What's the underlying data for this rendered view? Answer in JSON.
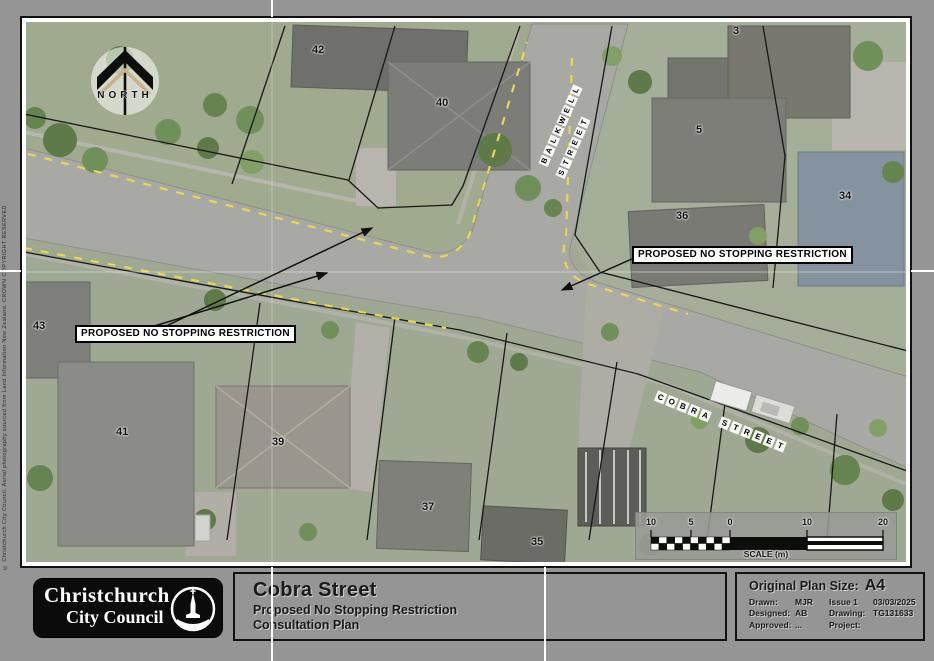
{
  "map": {
    "north_label": "NORTH",
    "copyright_text": "© Christchurch City Council. Aerial photography sourced from Land Information New Zealand. CROWN COPYRIGHT RESERVED. Licensed for re-use.",
    "labels": {
      "no_stopping_left": "PROPOSED NO STOPPING RESTRICTION",
      "no_stopping_right": "PROPOSED NO STOPPING RESTRICTION"
    },
    "streets": {
      "cobra": {
        "words": [
          "COBRA",
          "STREET"
        ]
      },
      "side": {
        "line1": "BALKWELL",
        "line2": "STREET"
      }
    },
    "house_numbers": [
      {
        "label": "42",
        "x": 312,
        "y": 44
      },
      {
        "label": "40",
        "x": 436,
        "y": 97
      },
      {
        "label": "3",
        "x": 733,
        "y": 25
      },
      {
        "label": "5",
        "x": 696,
        "y": 124
      },
      {
        "label": "36",
        "x": 676,
        "y": 210
      },
      {
        "label": "34",
        "x": 839,
        "y": 190
      },
      {
        "label": "43",
        "x": 33,
        "y": 320
      },
      {
        "label": "41",
        "x": 116,
        "y": 426
      },
      {
        "label": "39",
        "x": 272,
        "y": 436
      },
      {
        "label": "37",
        "x": 422,
        "y": 501
      },
      {
        "label": "35",
        "x": 531,
        "y": 536
      }
    ],
    "scale_bar": {
      "ticks": [
        "10",
        "5",
        "0",
        "10",
        "20"
      ],
      "caption": "SCALE (m)"
    }
  },
  "title_block": {
    "logo_line1": "Christchurch",
    "logo_line2": "City Council",
    "title": "Cobra Street",
    "subtitle1": "Proposed No Stopping Restriction",
    "subtitle2": "Consultation Plan",
    "plan_size_label": "Original Plan Size:",
    "plan_size_value": "A4",
    "drawn_label": "Drawn:",
    "drawn_value": "MJR",
    "issue_label": "Issue 1",
    "issue_date": "03/03/2025",
    "designed_label": "Designed:",
    "designed_value": "AB",
    "drawing_label": "Drawing:",
    "drawing_value": "TG131633",
    "approved_label": "Approved:",
    "approved_value": "...",
    "project_label": "Project:",
    "project_value": ""
  },
  "colors": {
    "proposal_yellow": "#e9d84e",
    "road_gray": "#a8a8a4",
    "sheet_gray": "#959595"
  }
}
